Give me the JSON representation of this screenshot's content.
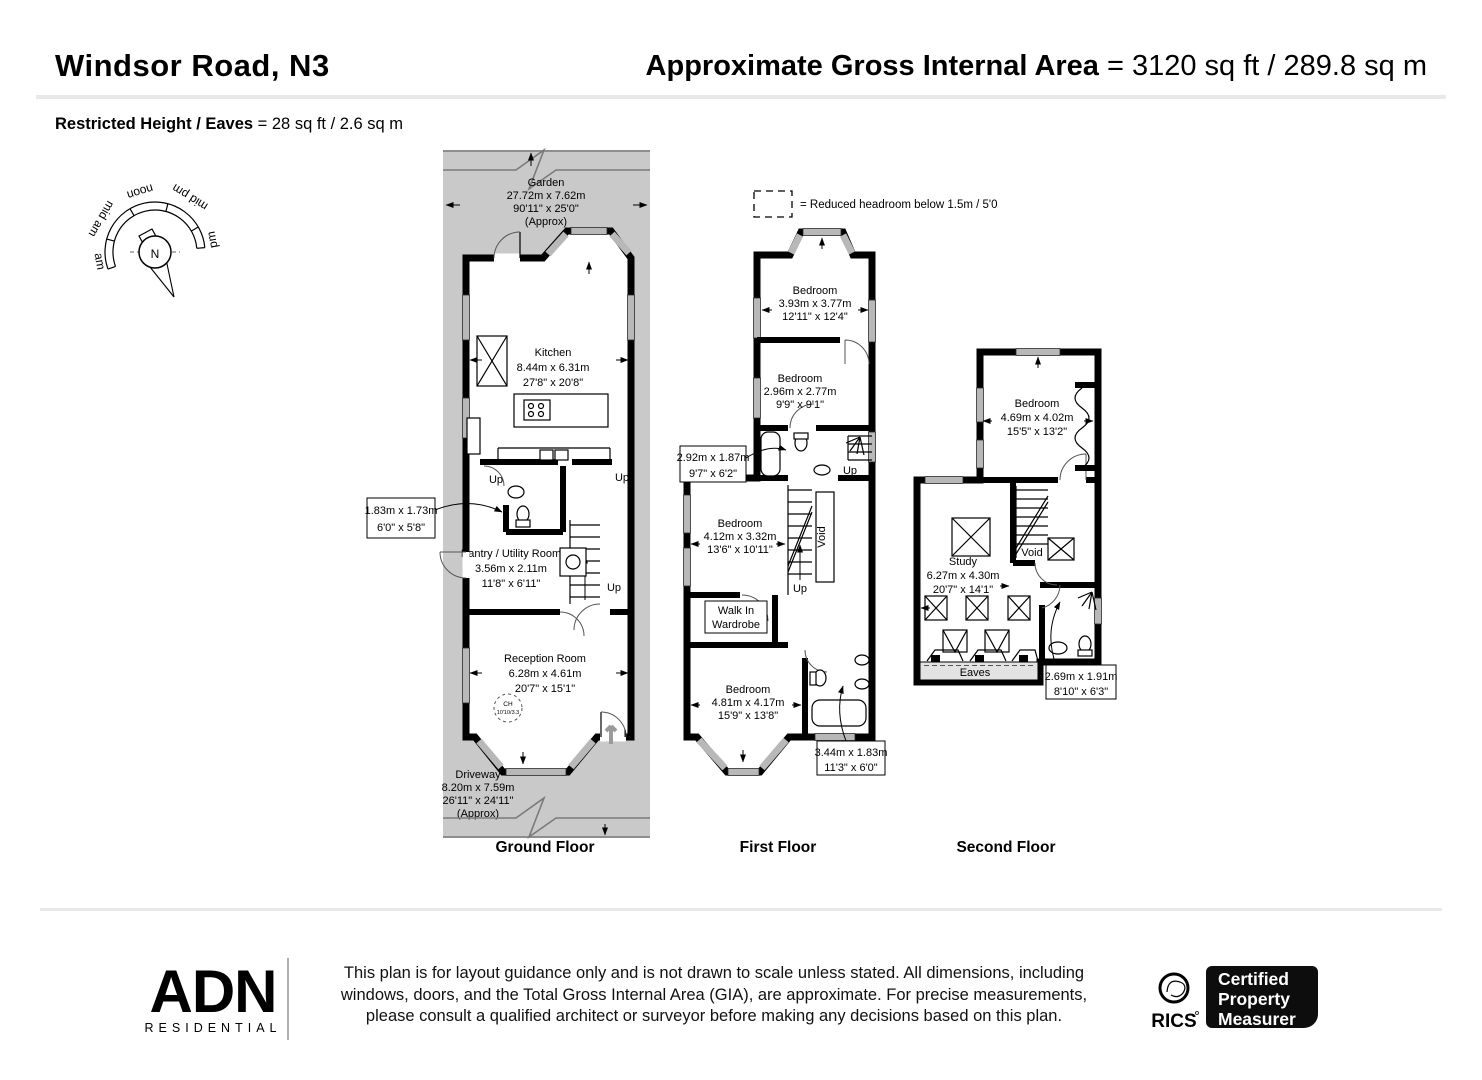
{
  "header": {
    "title": "Windsor Road, N3",
    "gia_label": "Approximate Gross Internal Area",
    "gia_value": " = 3120 sq ft / 289.8 sq m",
    "restricted_label": "Restricted Height / Eaves",
    "restricted_value": " = 28 sq ft / 2.6 sq m"
  },
  "compass": {
    "north": "N",
    "am": "am",
    "mid_am": "mid am",
    "noon": "noon",
    "mid_pm": "mid pm",
    "pm": "pm"
  },
  "legend": {
    "reduced_headroom": "= Reduced headroom below 1.5m / 5'0"
  },
  "ground_floor": {
    "label": "Ground Floor",
    "up": "Up",
    "in_label": "IN",
    "garden": {
      "name": "Garden",
      "metric": "27.72m x 7.62m",
      "imperial": "90'11\" x 25'0\"",
      "approx": "(Approx)"
    },
    "kitchen": {
      "name": "Kitchen",
      "metric": "8.44m x 6.31m",
      "imperial": "27'8\" x 20'8\""
    },
    "wc": {
      "metric": "1.83m x 1.73m",
      "imperial": "6'0\" x 5'8\""
    },
    "pantry": {
      "name": "Pantry / Utility Room",
      "metric": "3.56m x 2.11m",
      "imperial": "11'8\" x 6'11\""
    },
    "reception": {
      "name": "Reception Room",
      "metric": "6.28m x 4.61m",
      "imperial": "20'7\" x 15'1\""
    },
    "ceiling_height": {
      "line1": "CH",
      "line2": "10'10/3.3"
    },
    "driveway": {
      "name": "Driveway",
      "metric": "8.20m x 7.59m",
      "imperial": "26'11\" x 24'11\"",
      "approx": "(Approx)"
    }
  },
  "first_floor": {
    "label": "First Floor",
    "up": "Up",
    "void": "Void",
    "bedroom1": {
      "name": "Bedroom",
      "metric": "3.93m x 3.77m",
      "imperial": "12'11\" x 12'4\""
    },
    "bedroom2": {
      "name": "Bedroom",
      "metric": "2.96m x 2.77m",
      "imperial": "9'9\" x 9'1\""
    },
    "bathroom1": {
      "metric": "2.92m x 1.87m",
      "imperial": "9'7\" x 6'2\""
    },
    "bedroom3": {
      "name": "Bedroom",
      "metric": "4.12m x 3.32m",
      "imperial": "13'6\" x 10'11\""
    },
    "wardrobe": {
      "line1": "Walk In",
      "line2": "Wardrobe"
    },
    "bedroom4": {
      "name": "Bedroom",
      "metric": "4.81m x 4.17m",
      "imperial": "15'9\" x 13'8\""
    },
    "bathroom2": {
      "metric": "3.44m x 1.83m",
      "imperial": "11'3\" x 6'0\""
    }
  },
  "second_floor": {
    "label": "Second Floor",
    "void": "Void",
    "eaves": "Eaves",
    "bedroom": {
      "name": "Bedroom",
      "metric": "4.69m x 4.02m",
      "imperial": "15'5\" x 13'2\""
    },
    "study": {
      "name": "Study",
      "metric": "6.27m x 4.30m",
      "imperial": "20'7\" x 14'1\""
    },
    "shower_room": {
      "metric": "2.69m x 1.91m",
      "imperial": "8'10\" x 6'3\""
    }
  },
  "footer": {
    "disclaimer1": "This plan is for layout guidance only and is not drawn to scale unless stated. All dimensions, including",
    "disclaimer2": "windows, doors, and the Total Gross Internal Area (GIA), are approximate. For precise measurements,",
    "disclaimer3": "please consult a qualified architect or surveyor before making any decisions based on this plan.",
    "brand_name": "ADN",
    "brand_sub": "RESIDENTIAL",
    "rics_name": "RICS",
    "badge1": "Certified",
    "badge2": "Property",
    "badge3": "Measurer"
  },
  "colors": {
    "plot_gray": "#c9c9c9",
    "wall": "#000000",
    "window_gray": "#b8b8b8",
    "brand_brown": "#40291f",
    "divider": "#e9e9e9"
  }
}
